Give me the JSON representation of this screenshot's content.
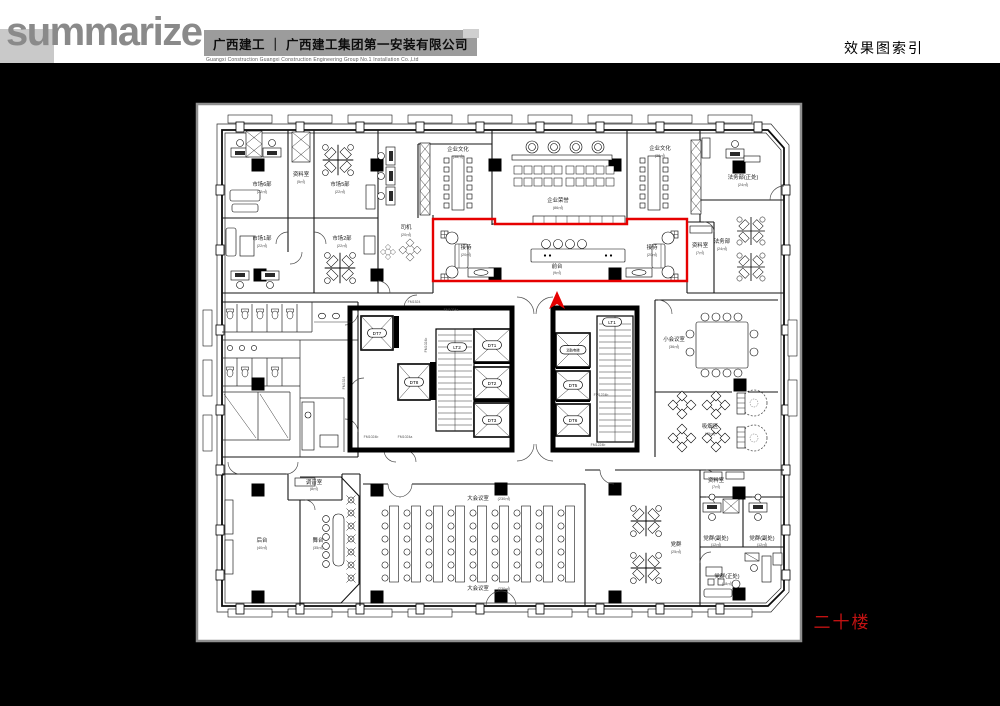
{
  "header": {
    "logo_text": "summarize",
    "company_cn": "广西建工 ｜ 广西建工集团第一安装有限公司",
    "company_en": "Guangxi Construction        Guangxi Construction Engineering Group No.1 Installation Co.,Ltd",
    "page_title": "效果图索引"
  },
  "plan": {
    "floor_label": "二十楼",
    "highlight_color": "#e60000",
    "rooms": {
      "market6": {
        "label": "市场6部",
        "area": "(22㎡)"
      },
      "market5": {
        "label": "市场5部",
        "area": "(22㎡)"
      },
      "market1": {
        "label": "市场1部",
        "area": "(22㎡)"
      },
      "market2": {
        "label": "市场2部",
        "area": "(22㎡)"
      },
      "storage_nw": {
        "label": "资料室",
        "area": "(5㎡)"
      },
      "driver": {
        "label": "司机",
        "area": "(20㎡)"
      },
      "culture_l": {
        "label": "企业文化",
        "area": "(38㎡)"
      },
      "honor": {
        "label": "企业荣誉",
        "area": "(86㎡)"
      },
      "culture_r": {
        "label": "企业文化",
        "area": "(38㎡)"
      },
      "legal_chief": {
        "label": "法务部(正处)",
        "area": "(24㎡)"
      },
      "legal": {
        "label": "法务部",
        "area": "(24㎡)"
      },
      "storage_ne": {
        "label": "资料室",
        "area": "(7㎡)"
      },
      "recep_l": {
        "label": "接待",
        "area": "(20㎡)"
      },
      "front_desk": {
        "label": "前台",
        "area": "(9㎡)"
      },
      "recep_r": {
        "label": "接待",
        "area": "(20㎡)"
      },
      "meeting_small": {
        "label": "小会议室",
        "area": "(36㎡)"
      },
      "smoking": {
        "label": "吸烟区",
        "area": "(45㎡)"
      },
      "sound": {
        "label": "调音室",
        "area": "(8㎡)"
      },
      "backstage": {
        "label": "后台",
        "area": "(40㎡)"
      },
      "stage": {
        "label": "舞台",
        "area": "(35㎡)"
      },
      "hall": {
        "label": "大会议室",
        "area": "(230㎡)"
      },
      "party": {
        "label": "党群",
        "area": "(25㎡)"
      },
      "storage_se": {
        "label": "资料室",
        "area": "(7㎡)"
      },
      "party_deputy": {
        "label": "党群(副处)",
        "area": "(12㎡)"
      },
      "party_chief": {
        "label": "党群(正处)",
        "area": "(18㎡)"
      }
    },
    "core": {
      "dt1": "DT1",
      "dt2": "DT2",
      "dt3": "DT3",
      "dt5": "DT5",
      "dt6": "DT6",
      "dt7": "DT7",
      "dt8": "DT8",
      "lt1": "LT1",
      "lt2": "LT2",
      "fire": "消防电梯"
    },
    "door_tags": {
      "fm1524": "FM1524",
      "fm1024a": "FM1024a",
      "fm1024b": "FM1024b",
      "fm1224b": "FM1224b"
    }
  }
}
